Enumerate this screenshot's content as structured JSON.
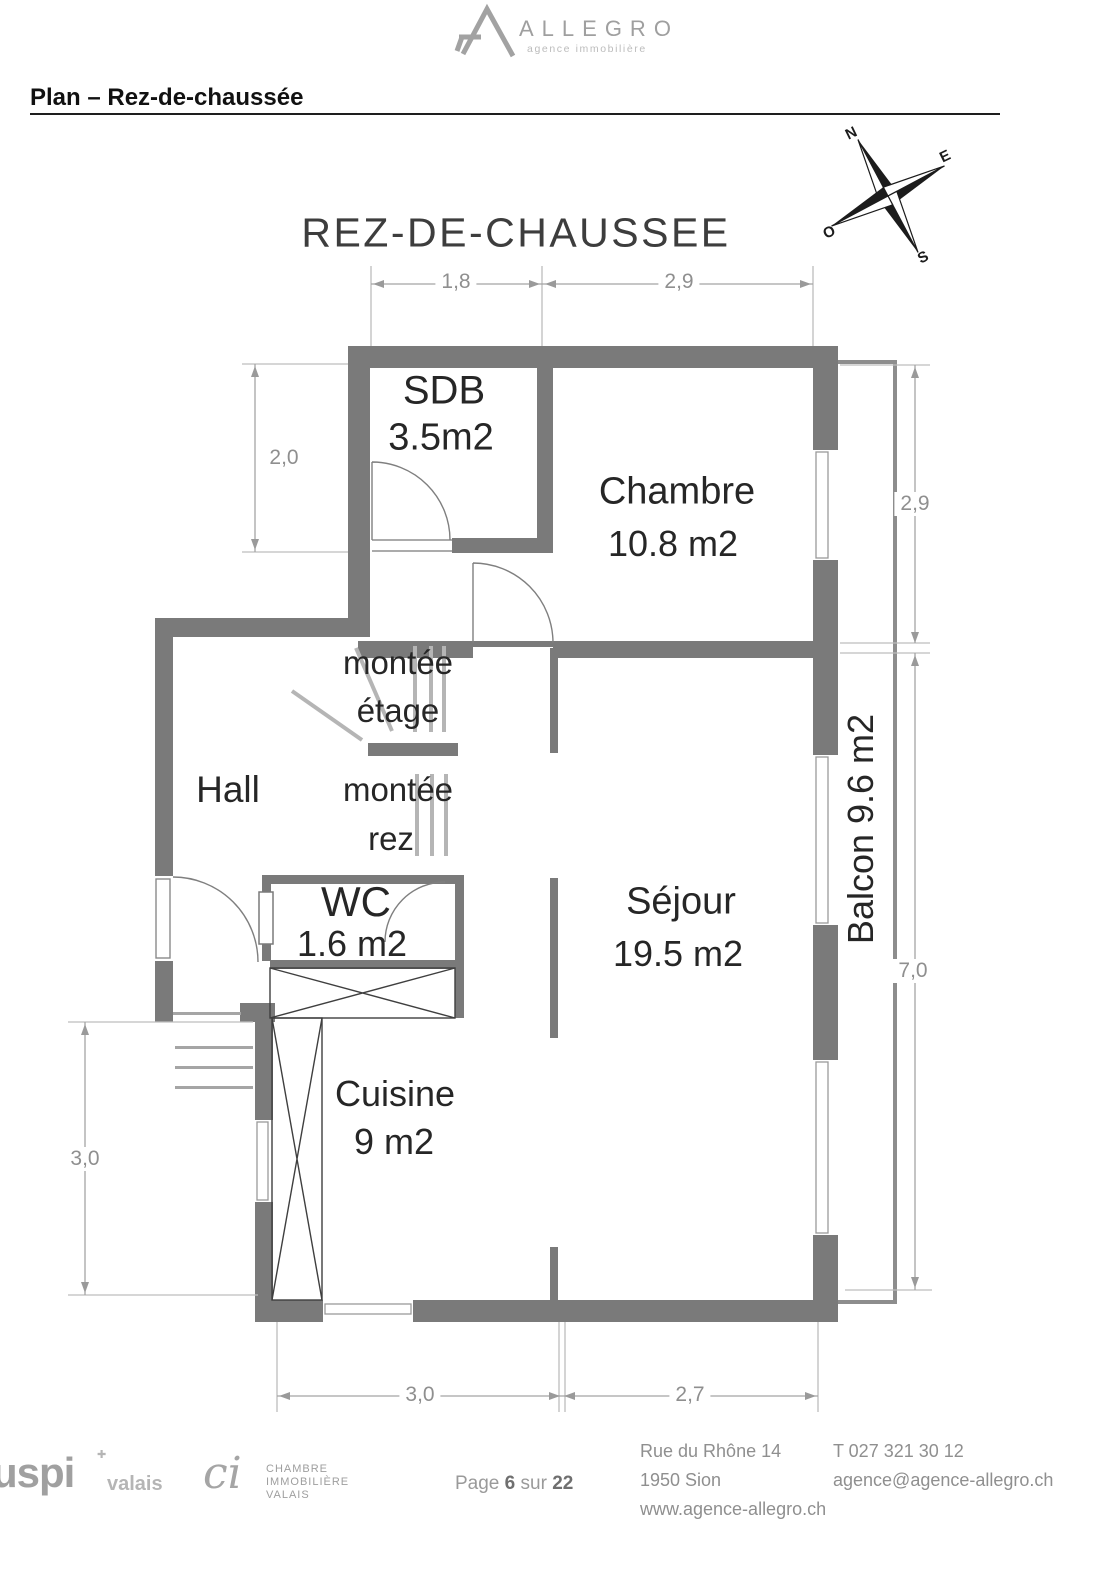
{
  "header": {
    "brand": "ALLEGRO",
    "brand_tagline": "agence immobilière",
    "page_title": "Plan – Rez-de-chaussée"
  },
  "plan": {
    "title": "REZ-DE-CHAUSSEE",
    "rooms": {
      "sdb": {
        "name": "SDB",
        "area": "3.5m2"
      },
      "chambre": {
        "name": "Chambre",
        "area": "10.8 m2"
      },
      "hall": {
        "name": "Hall"
      },
      "wc": {
        "name": "WC",
        "area": "1.6 m2"
      },
      "cuisine": {
        "name": "Cuisine",
        "area": "9 m2"
      },
      "sejour": {
        "name": "Séjour",
        "area": "19.5 m2"
      },
      "balcon": {
        "name": "Balcon 9.6 m2"
      }
    },
    "stairs": {
      "up_line1": "montée",
      "up_line2": "étage",
      "down_line1": "montée",
      "down_line2": "rez"
    },
    "dimensions": {
      "top_left": "1,8",
      "top_right": "2,9",
      "left_upper": "2,0",
      "left_lower": "3,0",
      "right_upper": "2,9",
      "right_lower": "7,0",
      "bottom_left": "3,0",
      "bottom_right": "2,7"
    },
    "compass": {
      "n": "N",
      "e": "E",
      "s": "S",
      "o": "O"
    }
  },
  "footer": {
    "uspi": {
      "name": "uspi",
      "region": "valais",
      "cross": "✚"
    },
    "chamber": {
      "mark": "ci",
      "line1": "CHAMBRE",
      "line2": "IMMOBILIÈRE",
      "line3": "VALAIS"
    },
    "page": {
      "label": "Page",
      "number": "6",
      "separator": "sur",
      "total": "22"
    },
    "address": {
      "line1": "Rue du Rhône 14",
      "line2": "1950 Sion",
      "line3": "www.agence-allegro.ch"
    },
    "contact": {
      "phone": "T 027 321 30 12",
      "email": "agence@agence-allegro.ch"
    }
  }
}
